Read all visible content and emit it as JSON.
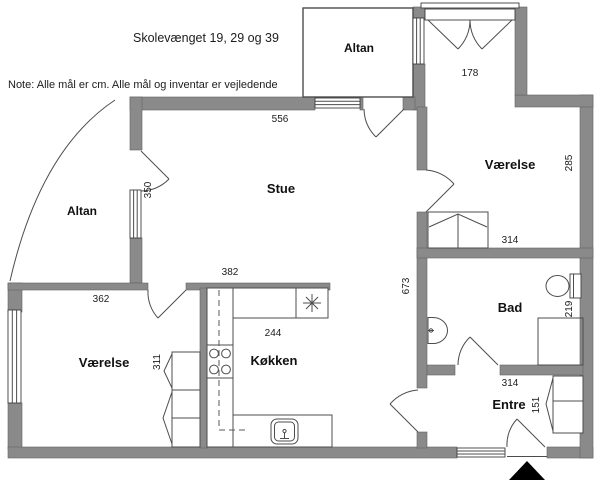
{
  "meta": {
    "width": 600,
    "height": 485,
    "drawing_type": "floor-plan"
  },
  "header": {
    "title": "Skolevænget 19, 29 og 39",
    "note": "Note: Alle mål er cm. Alle mål og inventar er vejledende"
  },
  "rooms": {
    "altan_top": {
      "label": "Altan"
    },
    "altan_left": {
      "label": "Altan"
    },
    "stue": {
      "label": "Stue",
      "width_cm": "556",
      "left_cm": "350",
      "bottom_cm": "382"
    },
    "vaerelse_ne": {
      "label": "Værelse",
      "width_cm": "314",
      "height_cm": "285",
      "terrace_door_cm": "178"
    },
    "vaerelse_sw": {
      "label": "Værelse",
      "width_cm": "362",
      "height_cm": "311"
    },
    "koekken": {
      "label": "Køkken",
      "width_cm": "244"
    },
    "bad": {
      "label": "Bad",
      "height_cm": "219"
    },
    "entre": {
      "label": "Entre",
      "width_cm": "314",
      "height_cm": "151"
    },
    "hall": {
      "length_cm": "673"
    }
  },
  "colors": {
    "wall": "#8a8a8a",
    "line": "#4c4c4c",
    "text": "#1c1c1c",
    "background": "#ffffff",
    "entrance_arrow": "#000000"
  }
}
